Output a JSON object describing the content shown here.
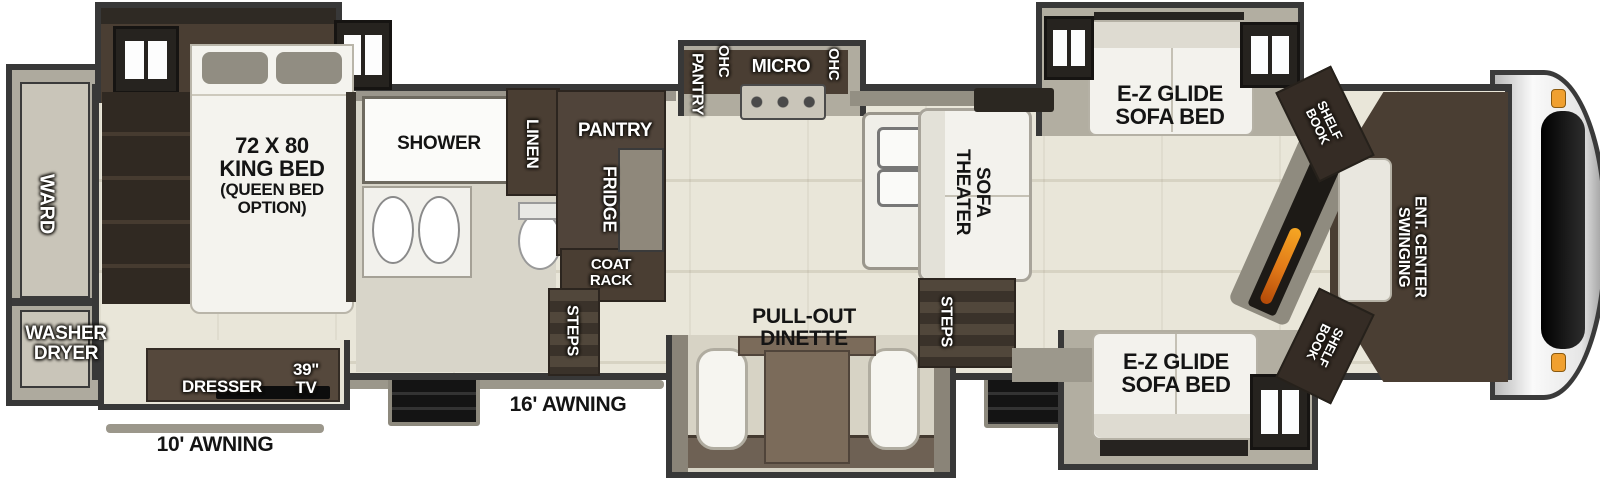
{
  "floorplan": {
    "bedroom": {
      "ward_label": "WARD",
      "washer_dryer": {
        "line1": "WASHER",
        "line2": "DRYER"
      },
      "bed": {
        "line1": "72 X 80",
        "line2": "KING BED",
        "line3": "(QUEEN BED",
        "line4": "OPTION)"
      },
      "dresser_label": "DRESSER",
      "tv": {
        "line1": "39\"",
        "line2": "TV"
      },
      "awning_label": "10' AWNING"
    },
    "bathroom": {
      "shower_label": "SHOWER",
      "linen_label": "LINEN"
    },
    "kitchen": {
      "pantry_label": "PANTRY",
      "fridge_label": "FRIDGE",
      "coat_rack": {
        "line1": "COAT",
        "line2": "RACK"
      },
      "steps_label": "STEPS",
      "overhead": {
        "pantry": "PANTRY",
        "ohc_left": "OHC",
        "micro": "MICRO",
        "ohc_right": "OHC"
      },
      "dinette": {
        "line1": "PULL-OUT",
        "line2": "DINETTE"
      },
      "awning_label": "16' AWNING"
    },
    "living": {
      "theater_sofa": {
        "line1": "THEATER",
        "line2": "SOFA"
      },
      "steps_label": "STEPS",
      "sofa_bed_top": {
        "line1": "E-Z GLIDE",
        "line2": "SOFA BED"
      },
      "sofa_bed_bottom": {
        "line1": "E-Z GLIDE",
        "line2": "SOFA BED"
      },
      "book_shelf_top": {
        "line1": "BOOK",
        "line2": "SHELF"
      },
      "book_shelf_bottom": {
        "line1": "BOOK",
        "line2": "SHELF"
      },
      "ent_center": {
        "line1": "SWINGING",
        "line2": "ENT. CENTER"
      }
    },
    "colors": {
      "outline": "#383838",
      "floor": "#e7e4d7",
      "cabinet": "#4a3e33",
      "slide_gray": "#b2aea1",
      "flame": "#e07818",
      "marker_light": "#f0a030"
    },
    "icons": {
      "windows": "window-icon",
      "stove": "stove-icon",
      "sinks": "sink-icon",
      "toilet": "toilet-icon",
      "fireplace": "fireplace-icon",
      "entry_steps": "entry-steps-icon"
    }
  }
}
